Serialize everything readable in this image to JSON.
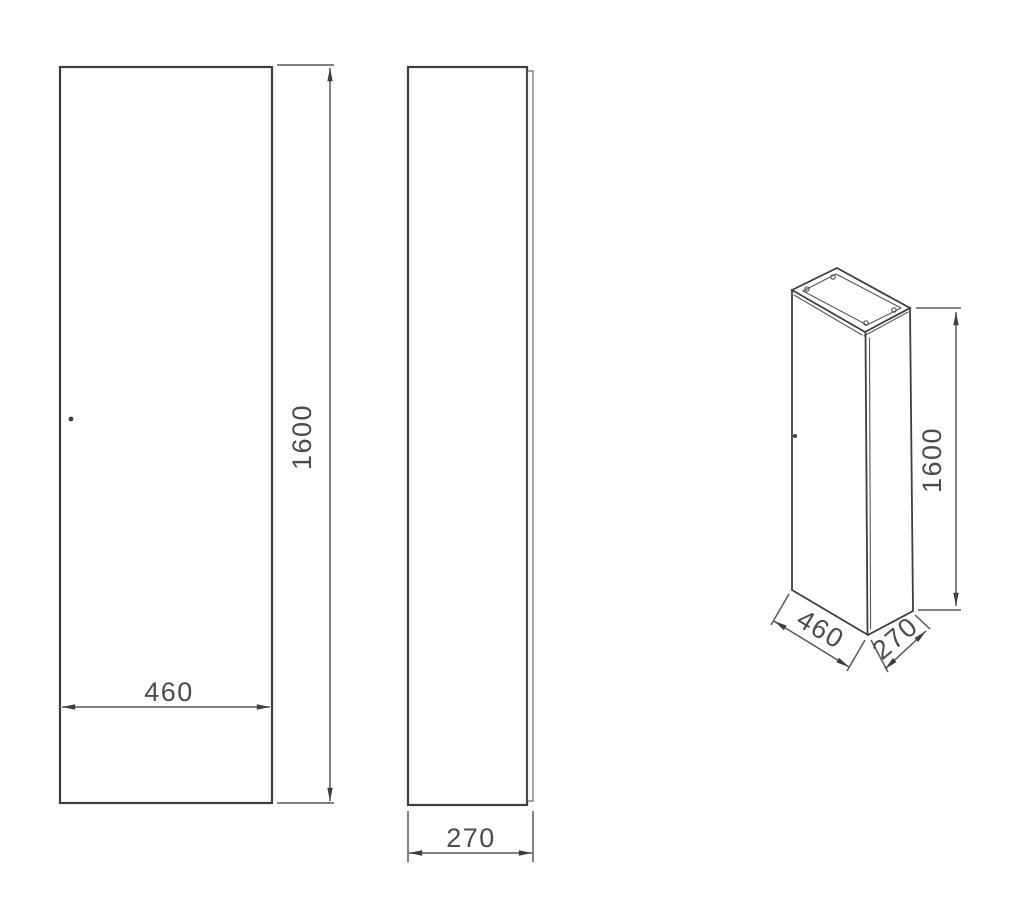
{
  "page": {
    "background": "#ffffff"
  },
  "drawing": {
    "type": "technical-orthographic-drawing",
    "subject": "tall-cabinet",
    "line_color": "#3e3e40",
    "thin_color": "#58585a",
    "dim_color": "#4c4c4e",
    "views": {
      "front": {
        "width_dim": {
          "label": "460"
        },
        "height_dim": {
          "label": "1600"
        }
      },
      "side": {
        "depth_dim": {
          "label": "270"
        }
      },
      "isometric": {
        "width_dim": {
          "label": "460"
        },
        "depth_dim": {
          "label": "270"
        },
        "height_dim": {
          "label": "1600"
        }
      }
    }
  }
}
